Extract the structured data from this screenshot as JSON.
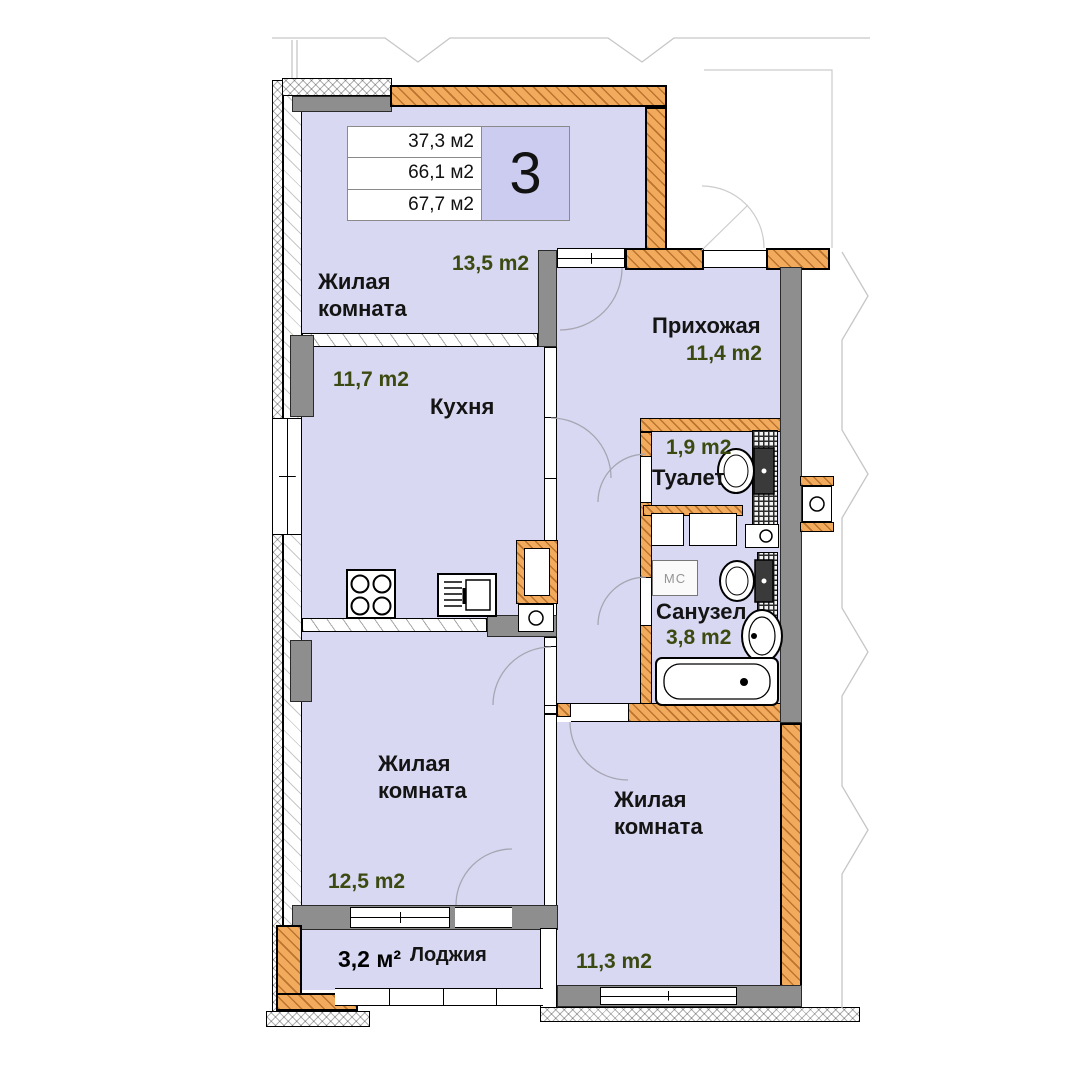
{
  "info_box": {
    "rows": [
      "37,3 м2",
      "66,1 м2",
      "67,7 м2"
    ],
    "rooms_count": "3"
  },
  "rooms": {
    "living_top": {
      "name": "Жилая\nкомната",
      "area": "13,5 m2"
    },
    "kitchen": {
      "name": "Кухня",
      "area": "11,7 m2"
    },
    "hallway": {
      "name": "Прихожая",
      "area": "11,4 m2"
    },
    "toilet": {
      "name": "Туалет",
      "area": "1,9 m2"
    },
    "bathroom": {
      "name": "Санузел",
      "area": "3,8 m2"
    },
    "living_left": {
      "name": "Жилая\nкомната",
      "area": "12,5 m2"
    },
    "living_right": {
      "name": "Жилая\nкомната",
      "area": "11,3 m2"
    },
    "loggia": {
      "name": "Лоджия",
      "area": "3,2 м²"
    }
  },
  "fixtures": {
    "washer_label": "МС"
  },
  "colors": {
    "room_fill": "#d8d8f2",
    "wall_orange": "#f2ab5c",
    "wall_gray": "#8e8e8e",
    "area_text": "#3b4a10",
    "text": "#141414"
  }
}
